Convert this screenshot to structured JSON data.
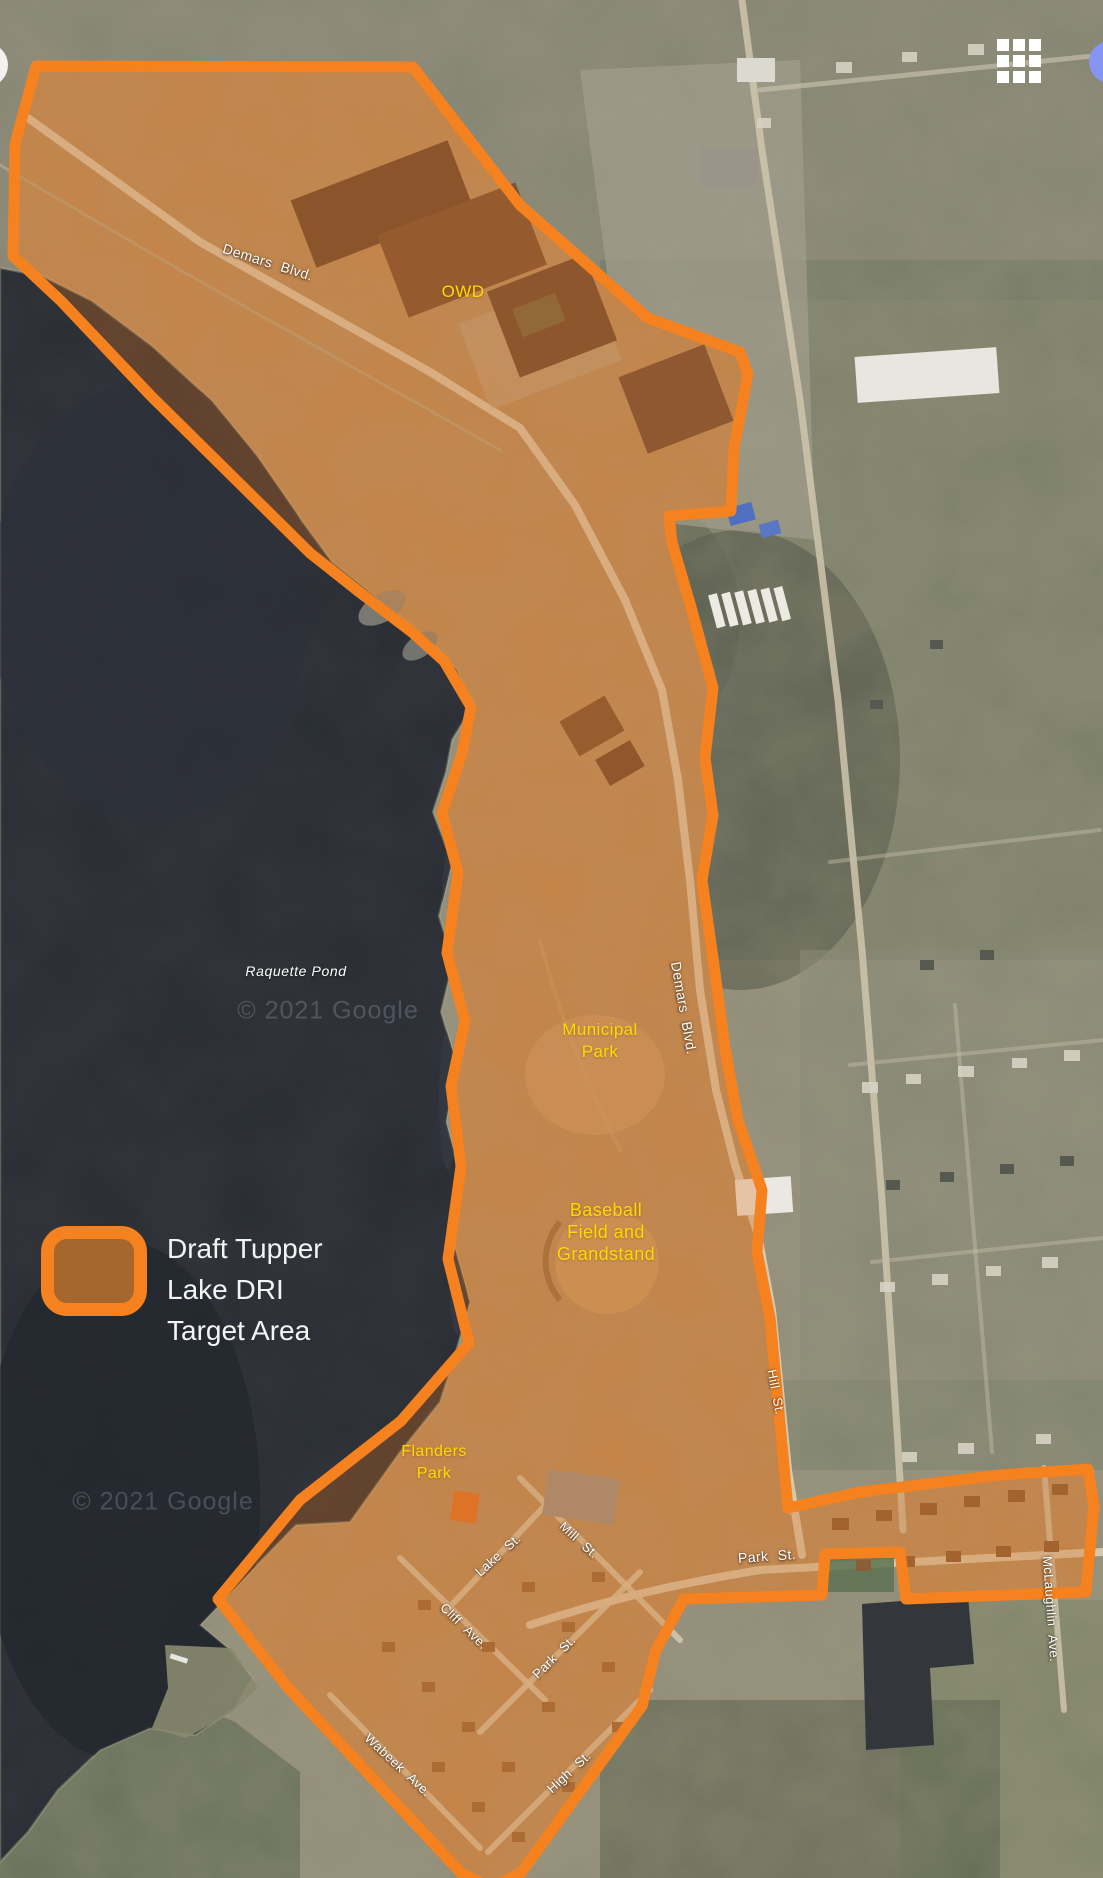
{
  "map_labels": {
    "demars_blvd_upper": "Demars Blvd.",
    "demars_blvd_lower": "Demars Blvd.",
    "owd": "OWD",
    "raquette_pond": "Raquette Pond",
    "municipal_park": [
      "Municipal",
      "Park"
    ],
    "baseball": [
      "Baseball",
      "Field and",
      "Grandstand"
    ],
    "flanders": [
      "Flanders",
      "Park"
    ],
    "lake_st": "Lake St.",
    "mill_st": "Mill St.",
    "cliff_ave": "Cliff Ave.",
    "park_st_southwest": "Park St.",
    "hill_st": "Hill St.",
    "park_st_east": "Park St.",
    "mclaughlin_ave": "McLaughlin Ave.",
    "wabeek_ave": "Wabeek Ave.",
    "high_st": "High St."
  },
  "legend": {
    "lines": [
      "Draft Tupper",
      "Lake DRI",
      "Target Area"
    ],
    "swatch_border_color": "#F5821F",
    "swatch_fill_color": "#A5672E"
  },
  "attribution": {
    "watermark_mid": "© 2021 Google",
    "watermark_south": "© 2021 Google"
  },
  "colors": {
    "boundary_orange": "#F5821F",
    "area_tint": "#C76E22",
    "water": "#262A32",
    "label_yellow": "#FFD900",
    "label_white": "#FFFFFF"
  },
  "icons": {
    "apps_grid": "3x3-white-grid",
    "avatar_partial": "blue-circle-right-edge",
    "control_partial": "white-circle-left-edge"
  }
}
